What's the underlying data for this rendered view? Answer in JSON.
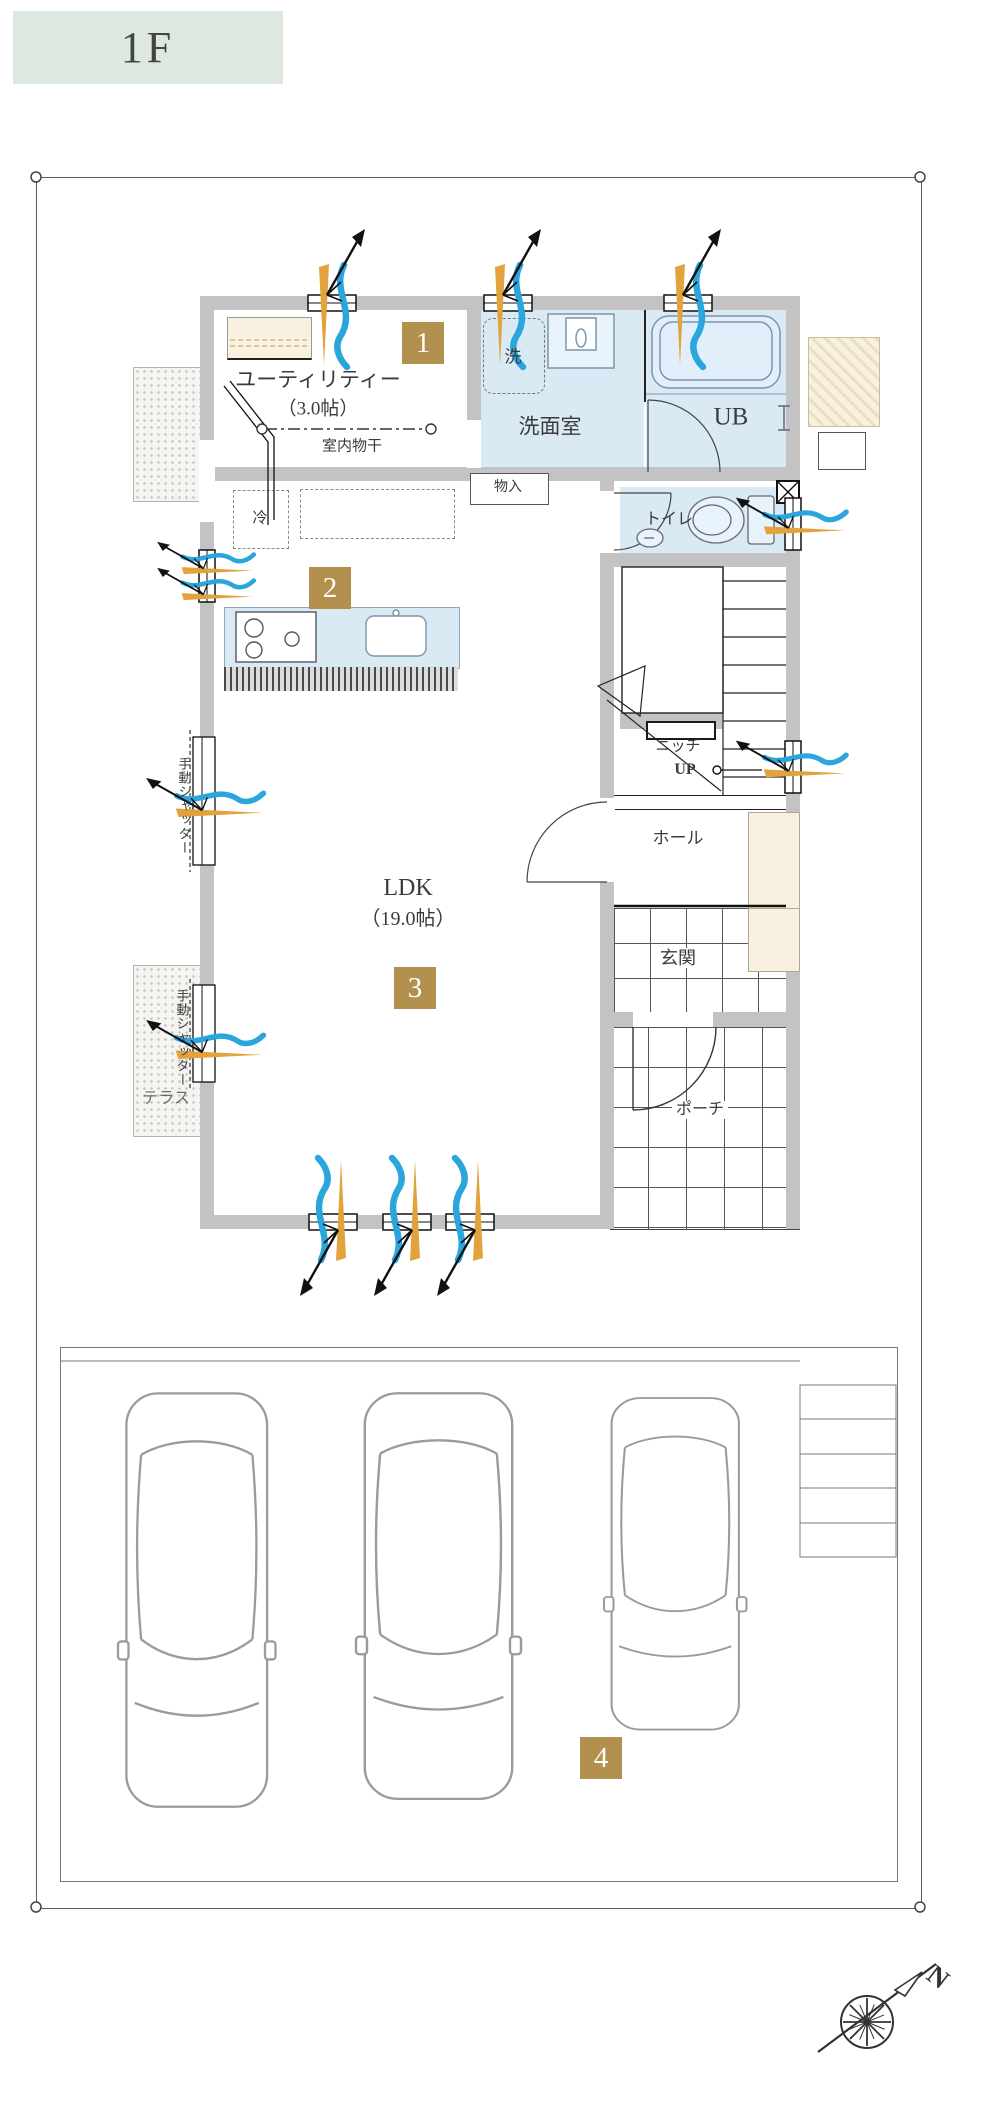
{
  "floor_label": "1F",
  "colors": {
    "floor_tag_bg": "#dde8e1",
    "badge_tan": "#b3904e",
    "room_blue": "#d9eaf5",
    "closet_cream": "#f8f1df",
    "wall_gray": "#c3c3c3",
    "arrow_blue": "#2aa6dd",
    "arrow_orange": "#e2a33c"
  },
  "badges": {
    "b1": "1",
    "b2": "2",
    "b3": "3",
    "b4": "4"
  },
  "rooms": {
    "utility": {
      "name": "ユーティリティー",
      "size": "（3.0帖）",
      "drying_note": "室内物干"
    },
    "washroom": {
      "name": "洗面室",
      "washer": "洗"
    },
    "bath": {
      "name": "UB"
    },
    "toilet": {
      "name": "トイレ"
    },
    "storage": "物入",
    "fridge": "冷",
    "stairs": {
      "niche": "ニッチ",
      "up": "UP"
    },
    "hall": "ホール",
    "entrance": "玄関",
    "porch": "ポーチ",
    "terrace": "テラス",
    "ldk": {
      "name": "LDK",
      "size": "（19.0帖）"
    },
    "shutter": "手動シャッター"
  },
  "compass": {
    "north": "N"
  }
}
